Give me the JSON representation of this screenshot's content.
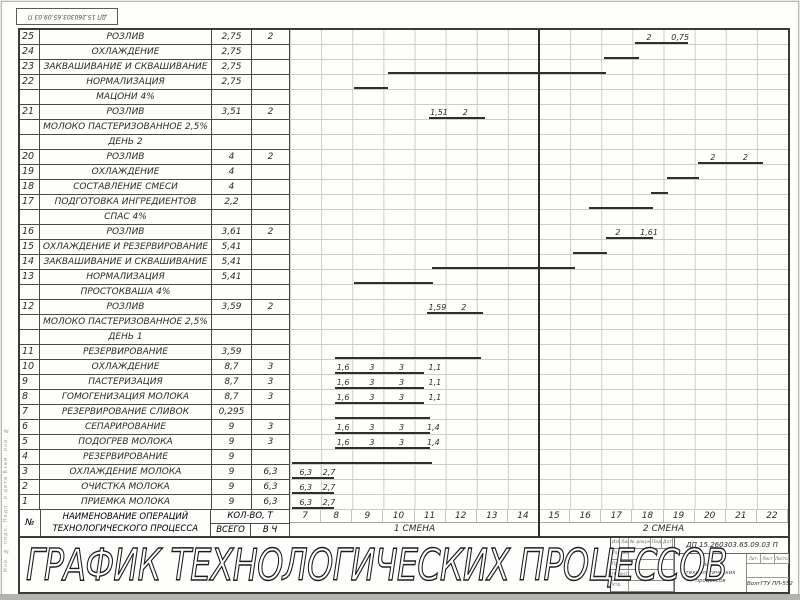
{
  "sheet": {
    "corner_stamp": "ДП 15.260303.65.09.03 П",
    "big_title": "ГРАФИК ТЕХНОЛОГИЧЕСКИХ ПРОЦЕССОВ",
    "margin_stamp": "Инв. № подл.    Подп. и дата    Взам. инв. №"
  },
  "table": {
    "headers": {
      "col_no": "№",
      "col_name_line1": "НАИМЕНОВАНИЕ ОПЕРАЦИЙ",
      "col_name_line2": "ТЕХНОЛОГИЧЕСКОГО ПРОЦЕССА",
      "col_qty_top": "КОЛ-ВО, Т",
      "col_qty_bottom": "ВСЕГО",
      "col_rate_bottom": "В Ч"
    },
    "hours": [
      "7",
      "8",
      "9",
      "10",
      "11",
      "12",
      "13",
      "14",
      "15",
      "16",
      "17",
      "18",
      "19",
      "20",
      "21",
      "22"
    ],
    "shifts": [
      "1 СМЕНА",
      "2 СМЕНА"
    ]
  },
  "chart_data": {
    "type": "bar",
    "subtype": "gantt-process-schedule",
    "title": "ГРАФИК ТЕХНОЛОГИЧЕСКИХ ПРОЦЕССОВ",
    "x_axis": {
      "label_units": "hours",
      "range": [
        7,
        23
      ],
      "ticks": [
        7,
        8,
        9,
        10,
        11,
        12,
        13,
        14,
        15,
        16,
        17,
        18,
        19,
        20,
        21,
        22
      ],
      "shift1": "часы 7–14",
      "shift2": "часы 15–22"
    },
    "rows": [
      {
        "num": "25",
        "name": "РОЗЛИВ",
        "qty": "2,75",
        "rate": "2",
        "bar": [
          18.1,
          19.8
        ],
        "labels": [
          [
            "2",
            18.45
          ],
          [
            "0,75",
            19.25
          ]
        ]
      },
      {
        "num": "24",
        "name": "ОХЛАЖДЕНИЕ",
        "qty": "2,75",
        "rate": "",
        "bar": [
          17.1,
          18.2
        ],
        "labels": []
      },
      {
        "num": "23",
        "name": "ЗАКВАШИВАНИЕ И СКВАШИВАНИЕ",
        "qty": "2,75",
        "rate": "",
        "bar": [
          10.15,
          17.15
        ],
        "labels": []
      },
      {
        "num": "22",
        "name": "НОРМАЛИЗАЦИЯ",
        "qty": "2,75",
        "rate": "",
        "bar": [
          9.05,
          10.15
        ],
        "labels": []
      },
      {
        "num": "",
        "name": "МАЦОНИ 4%",
        "qty": "",
        "rate": "",
        "bar": null,
        "labels": []
      },
      {
        "num": "21",
        "name": "РОЗЛИВ",
        "qty": "3,51",
        "rate": "2",
        "bar": [
          11.45,
          13.25
        ],
        "labels": [
          [
            "1,51",
            11.5
          ],
          [
            "2",
            12.55
          ]
        ]
      },
      {
        "num": "",
        "name": "МОЛОКО ПАСТЕРИЗОВАННОЕ 2,5%",
        "qty": "",
        "rate": "",
        "bar": null,
        "labels": []
      },
      {
        "num": "",
        "name": "ДЕНЬ 2",
        "qty": "",
        "rate": "",
        "bar": null,
        "labels": []
      },
      {
        "num": "20",
        "name": "РОЗЛИВ",
        "qty": "4",
        "rate": "2",
        "bar": [
          20.1,
          22.2
        ],
        "labels": [
          [
            "2",
            20.5
          ],
          [
            "2",
            21.55
          ]
        ]
      },
      {
        "num": "19",
        "name": "ОХЛАЖДЕНИЕ",
        "qty": "4",
        "rate": "",
        "bar": [
          19.1,
          20.15
        ],
        "labels": []
      },
      {
        "num": "18",
        "name": "СОСТАВЛЕНИЕ СМЕСИ",
        "qty": "4",
        "rate": "",
        "bar": [
          18.6,
          19.15
        ],
        "labels": []
      },
      {
        "num": "17",
        "name": "ПОДГОТОВКА ИНГРЕДИЕНТОВ",
        "qty": "2,2",
        "rate": "",
        "bar": [
          16.6,
          18.65
        ],
        "labels": []
      },
      {
        "num": "",
        "name": "СПАС 4%",
        "qty": "",
        "rate": "",
        "bar": null,
        "labels": []
      },
      {
        "num": "16",
        "name": "РОЗЛИВ",
        "qty": "3,61",
        "rate": "2",
        "bar": [
          17.15,
          18.65
        ],
        "labels": [
          [
            "2",
            17.45
          ],
          [
            "1,61",
            18.25
          ]
        ]
      },
      {
        "num": "15",
        "name": "ОХЛАЖДЕНИЕ И РЕЗЕРВИРОВАНИЕ",
        "qty": "5,41",
        "rate": "",
        "bar": [
          16.1,
          17.2
        ],
        "labels": []
      },
      {
        "num": "14",
        "name": "ЗАКВАШИВАНИЕ И СКВАШИВАНИЕ",
        "qty": "5,41",
        "rate": "",
        "bar": [
          11.55,
          16.15
        ],
        "labels": []
      },
      {
        "num": "13",
        "name": "НОРМАЛИЗАЦИЯ",
        "qty": "5,41",
        "rate": "",
        "bar": [
          9.05,
          11.6
        ],
        "labels": []
      },
      {
        "num": "",
        "name": "ПРОСТОКВАША 4%",
        "qty": "",
        "rate": "",
        "bar": null,
        "labels": []
      },
      {
        "num": "12",
        "name": "РОЗЛИВ",
        "qty": "3,59",
        "rate": "2",
        "bar": [
          11.4,
          13.2
        ],
        "labels": [
          [
            "1,59",
            11.45
          ],
          [
            "2",
            12.5
          ]
        ]
      },
      {
        "num": "",
        "name": "МОЛОКО ПАСТЕРИЗОВАННОЕ 2,5%",
        "qty": "",
        "rate": "",
        "bar": null,
        "labels": []
      },
      {
        "num": "",
        "name": "ДЕНЬ 1",
        "qty": "",
        "rate": "",
        "bar": null,
        "labels": []
      },
      {
        "num": "11",
        "name": "РЕЗЕРВИРОВАНИЕ",
        "qty": "3,59",
        "rate": "",
        "bar": [
          8.45,
          13.15
        ],
        "labels": []
      },
      {
        "num": "10",
        "name": "ОХЛАЖДЕНИЕ",
        "qty": "8,7",
        "rate": "3",
        "bar": [
          8.45,
          11.3
        ],
        "labels": [
          [
            "1,6",
            8.5
          ],
          [
            "3",
            9.55
          ],
          [
            "3",
            10.5
          ],
          [
            "1,1",
            11.45
          ]
        ]
      },
      {
        "num": "9",
        "name": "ПАСТЕРИЗАЦИЯ",
        "qty": "8,7",
        "rate": "3",
        "bar": [
          8.45,
          11.3
        ],
        "labels": [
          [
            "1,6",
            8.5
          ],
          [
            "3",
            9.55
          ],
          [
            "3",
            10.5
          ],
          [
            "1,1",
            11.45
          ]
        ]
      },
      {
        "num": "8",
        "name": "ГОМОГЕНИЗАЦИЯ МОЛОКА",
        "qty": "8,7",
        "rate": "3",
        "bar": [
          8.45,
          11.3
        ],
        "labels": [
          [
            "1,6",
            8.5
          ],
          [
            "3",
            9.55
          ],
          [
            "3",
            10.5
          ],
          [
            "1,1",
            11.45
          ]
        ]
      },
      {
        "num": "7",
        "name": "РЕЗЕРВИРОВАНИЕ СЛИВОК",
        "qty": "0,295",
        "rate": "",
        "bar": [
          8.45,
          11.5
        ],
        "labels": []
      },
      {
        "num": "6",
        "name": "СЕПАРИРОВАНИЕ",
        "qty": "9",
        "rate": "3",
        "bar": [
          8.45,
          11.5
        ],
        "labels": [
          [
            "1,6",
            8.5
          ],
          [
            "3",
            9.55
          ],
          [
            "3",
            10.5
          ],
          [
            "1,4",
            11.4
          ]
        ]
      },
      {
        "num": "5",
        "name": "ПОДОГРЕВ МОЛОКА",
        "qty": "9",
        "rate": "3",
        "bar": [
          8.45,
          11.5
        ],
        "labels": [
          [
            "1,6",
            8.5
          ],
          [
            "3",
            9.55
          ],
          [
            "3",
            10.5
          ],
          [
            "1,4",
            11.4
          ]
        ]
      },
      {
        "num": "4",
        "name": "РЕЗЕРВИРОВАНИЕ",
        "qty": "9",
        "rate": "",
        "bar": [
          7.05,
          11.55
        ],
        "labels": []
      },
      {
        "num": "3",
        "name": "ОХЛАЖДЕНИЕ МОЛОКА",
        "qty": "9",
        "rate": "6,3",
        "bar": [
          7.05,
          8.4
        ],
        "labels": [
          [
            "6,3",
            7.3
          ],
          [
            "2,7",
            8.05
          ]
        ]
      },
      {
        "num": "2",
        "name": "ОЧИСТКА МОЛОКА",
        "qty": "9",
        "rate": "6,3",
        "bar": [
          7.05,
          8.4
        ],
        "labels": [
          [
            "6,3",
            7.3
          ],
          [
            "2,7",
            8.05
          ]
        ]
      },
      {
        "num": "1",
        "name": "ПРИЕМКА МОЛОКА",
        "qty": "9",
        "rate": "6,3",
        "bar": [
          7.05,
          8.4
        ],
        "labels": [
          [
            "6,3",
            7.3
          ],
          [
            "2,7",
            8.05
          ]
        ]
      }
    ]
  },
  "title_block": {
    "doc_number": "ДП 15.260303.65.09.03 П",
    "doc_title_line1": "График технологических",
    "doc_title_line2": "процессов",
    "org": "ВолгГТУ ПП-552",
    "left_header": [
      "Изм.",
      "Лист",
      "№ докум.",
      "Подп.",
      "Дата"
    ],
    "left_rows": [
      "Разраб.",
      "Пров.",
      "Н.контр.",
      "Утв."
    ],
    "mini_header": [
      "Лит.",
      "Лист",
      "Листов"
    ]
  },
  "colors": {
    "line_dark": "#2e2e2c",
    "grid_light": "#cbcbc9",
    "paper": "#fdfdfb"
  }
}
